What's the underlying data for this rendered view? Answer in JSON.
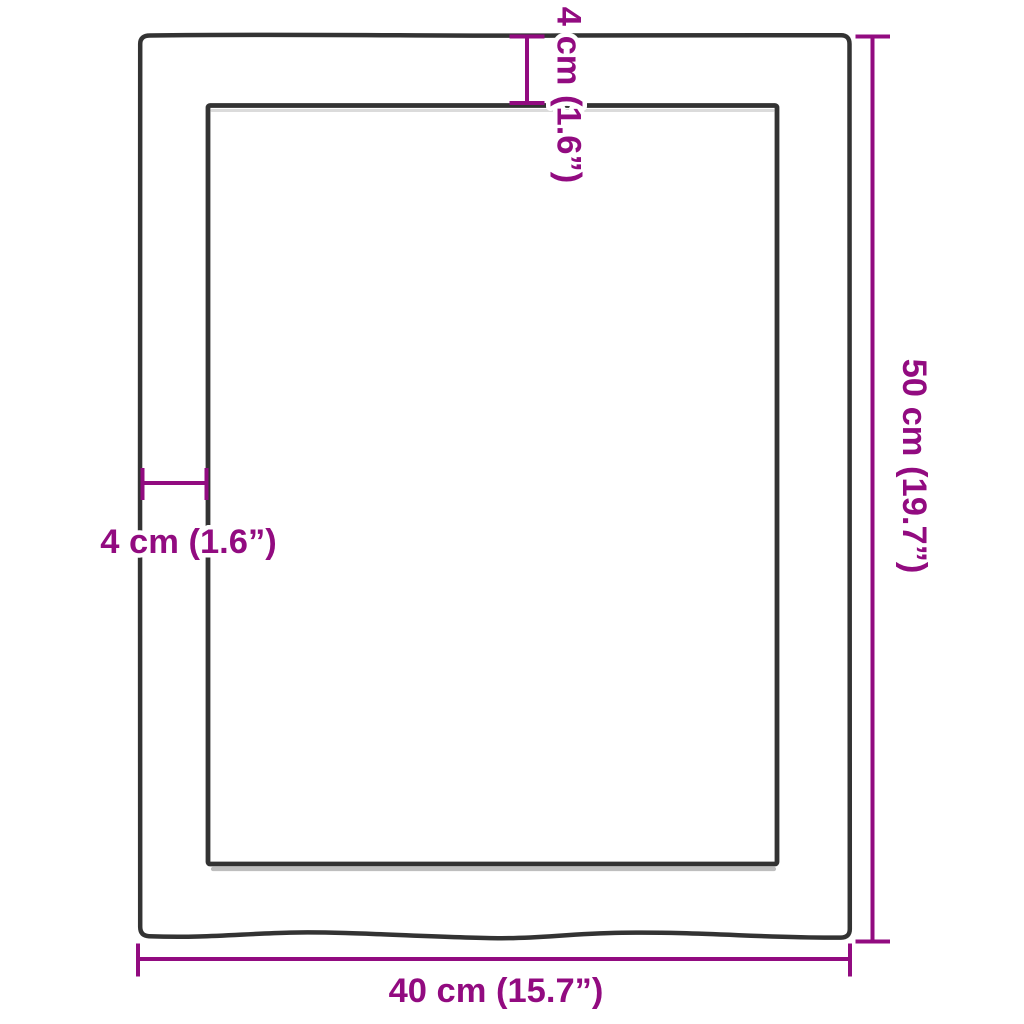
{
  "diagram": {
    "kind": "product-dimension-diagram",
    "subject": "rectangular wooden board top view with inner recess outline",
    "accent_color": "#920b80",
    "outline_color": "#333333",
    "shadow_color": "#8a8a8a",
    "background_color": "#ffffff",
    "labels": {
      "top_thickness": "4 cm (1.6”)",
      "left_thickness": "4 cm (1.6”)",
      "height": "50 cm (19.7”)",
      "width": "40 cm (15.7”)"
    },
    "measurements": {
      "width": {
        "cm": 40,
        "inches": 15.7
      },
      "height": {
        "cm": 50,
        "inches": 19.7
      },
      "edge_thickness": {
        "cm": 4,
        "inches": 1.6
      }
    }
  }
}
